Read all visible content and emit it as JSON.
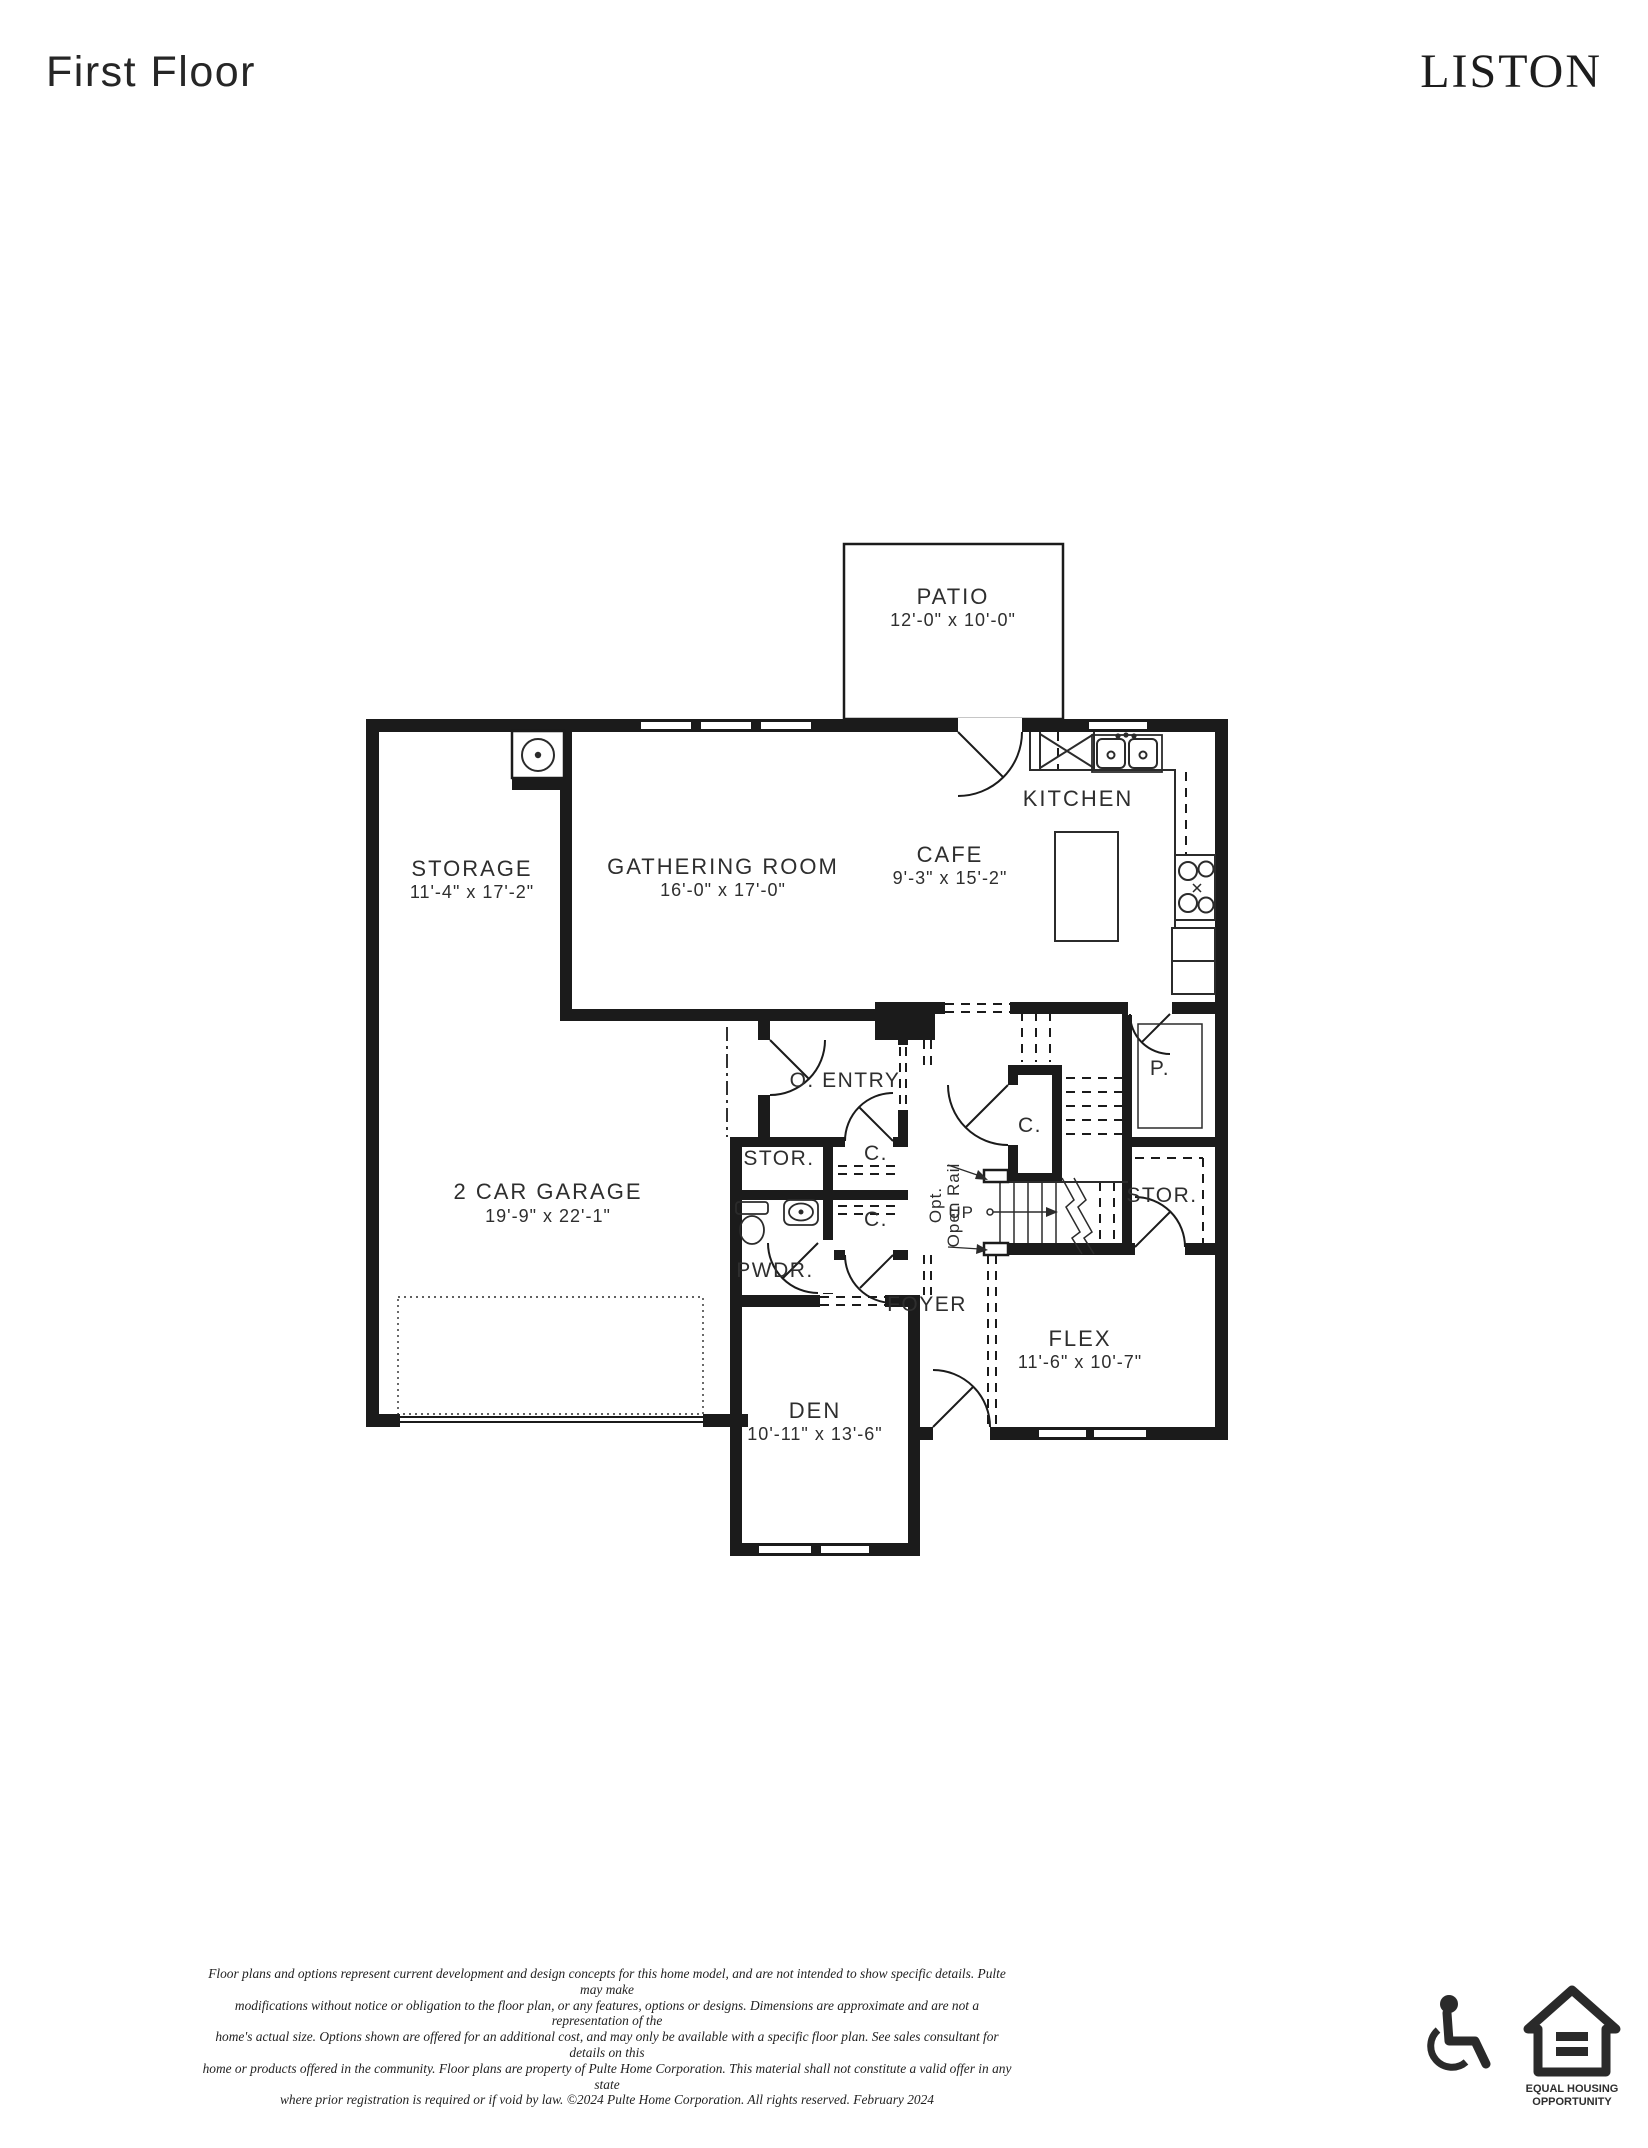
{
  "header": {
    "title": "First Floor",
    "model": "LISTON"
  },
  "plan": {
    "rooms": {
      "patio": {
        "name": "PATIO",
        "dims": "12'-0\" x 10'-0\""
      },
      "kitchen": {
        "name": "KITCHEN"
      },
      "cafe": {
        "name": "CAFE",
        "dims": "9'-3\" x 15'-2\""
      },
      "gathering": {
        "name": "GATHERING ROOM",
        "dims": "16'-0\" x 17'-0\""
      },
      "storage": {
        "name": "STORAGE",
        "dims": "11'-4\" x 17'-2\""
      },
      "owners_entry": {
        "name": "O. ENTRY"
      },
      "stor_left": {
        "name": "STOR."
      },
      "closet_a": {
        "name": "C."
      },
      "closet_b": {
        "name": "C."
      },
      "closet_stair": {
        "name": "C."
      },
      "powder": {
        "name": "PWDR."
      },
      "pantry": {
        "name": "P."
      },
      "stor_right": {
        "name": "STOR."
      },
      "garage": {
        "name": "2 CAR GARAGE",
        "dims": "19'-9\" x 22'-1\""
      },
      "foyer": {
        "name": "FOYER"
      },
      "flex": {
        "name": "FLEX",
        "dims": "11'-6\" x 10'-7\""
      },
      "den": {
        "name": "DEN",
        "dims": "10'-11\" x 13'-6\""
      }
    },
    "stairs": {
      "up_label": "UP",
      "open_rail_lines": [
        "Opt.",
        "Open Rail"
      ]
    }
  },
  "footer": {
    "disclaimer_lines": [
      "Floor plans and options represent current development and design concepts for this home model, and are not intended to show specific details.  Pulte may make",
      "modifications without notice or obligation to the floor plan, or any features, options or designs.  Dimensions are approximate and are not a representation of the",
      "home's actual size. Options shown are offered for an additional cost, and may only be available with a specific floor plan.  See sales consultant for details on this",
      "home or products offered in the community.  Floor plans are property of Pulte Home Corporation.  This material shall not constitute a valid offer in any state",
      "where prior registration is required or if void by law.   ©2024 Pulte Home Corporation.  All rights reserved.  February 2024"
    ],
    "equal_housing": {
      "line1": "EQUAL HOUSING",
      "line2": "OPPORTUNITY"
    }
  },
  "colors": {
    "wall": "#1b1b1b",
    "line": "#2b2b2b",
    "text": "#2e2e2e",
    "bg": "#ffffff"
  }
}
